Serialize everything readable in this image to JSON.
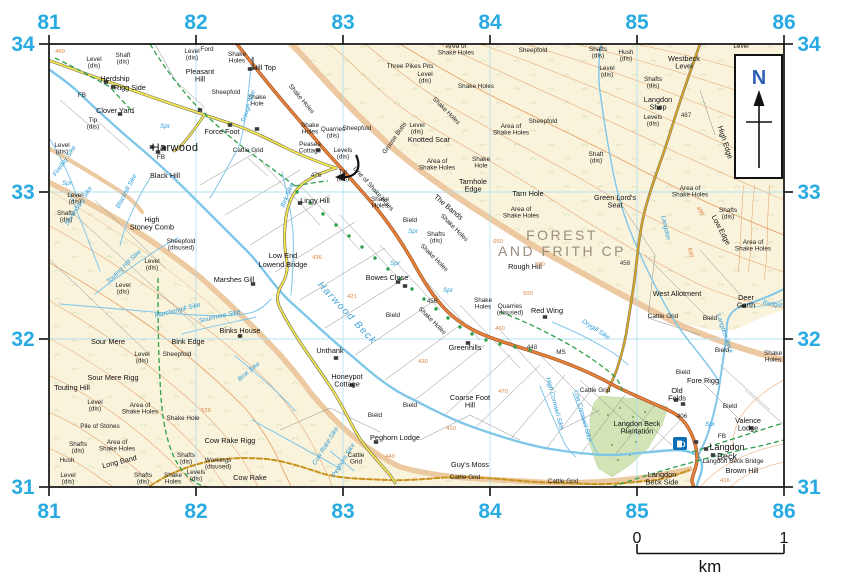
{
  "colors": {
    "grid_labels": "#29abe2",
    "b_road": "#e8803a",
    "minor_road": "#f5e74e",
    "track": "#c9921e",
    "water": "#7fc6e8",
    "footpath_green": "#2da04a",
    "contour": "#e2975c",
    "access_land": "#faf3dc",
    "woodland": "#d2e4b6",
    "cp_text": "#9a8d7d",
    "north_letter": "#2f5fb3",
    "pub_symbol": "#0d6eb5"
  },
  "map": {
    "north_label": "N",
    "scale": {
      "start": "0",
      "end": "1",
      "unit": "km"
    },
    "grid": {
      "x": {
        "labels": [
          "81",
          "82",
          "83",
          "84",
          "85",
          "86"
        ],
        "pos": [
          49,
          196,
          343,
          490,
          637,
          784
        ]
      },
      "y": {
        "labels": [
          "34",
          "33",
          "32",
          "31"
        ],
        "pos": [
          44,
          192,
          339,
          487
        ]
      }
    },
    "labels": [
      [
        94,
        61,
        "Level|(dis)",
        "s"
      ],
      [
        123,
        57,
        "Shaft|(dis)",
        "s"
      ],
      [
        115,
        81,
        "Herdship",
        "p"
      ],
      [
        130,
        90,
        "Rigg Side",
        "p"
      ],
      [
        82,
        97,
        "FB",
        "s"
      ],
      [
        115,
        113,
        "Clover Yard",
        "p"
      ],
      [
        93,
        122,
        "Tip|(dis)",
        "s"
      ],
      [
        62,
        147,
        "Level|(dis)",
        "s"
      ],
      [
        175,
        151,
        "Harwood",
        "t"
      ],
      [
        161,
        159,
        "FB",
        "s"
      ],
      [
        165,
        178,
        "Black Hill",
        "p"
      ],
      [
        192,
        53,
        "Level|(dis)",
        "s"
      ],
      [
        207,
        51,
        "Ford",
        "s"
      ],
      [
        200,
        74,
        "Pleasant|Hill",
        "p"
      ],
      [
        237,
        56,
        "Shake|Holes",
        "s"
      ],
      [
        226,
        94,
        "Sheepfold",
        "s"
      ],
      [
        257,
        99,
        "Shake|Hole",
        "s"
      ],
      [
        264,
        70,
        "Hill Top",
        "p"
      ],
      [
        222,
        134,
        "Force Foot",
        "p"
      ],
      [
        248,
        152,
        "Cattle Grid",
        "s"
      ],
      [
        67,
        185,
        "Spr",
        "w"
      ],
      [
        165,
        128,
        "Spr",
        "w"
      ],
      [
        250,
        107,
        "Trough Sike",
        "w",
        -72
      ],
      [
        66,
        162,
        "Fireday Sike",
        "w",
        -55
      ],
      [
        300,
        100,
        "Shake Holes",
        "s",
        50
      ],
      [
        310,
        127,
        "Shake|Holes",
        "s"
      ],
      [
        333,
        131,
        "Quarries|(dis)",
        "s"
      ],
      [
        357,
        130,
        "Sheepfold",
        "s"
      ],
      [
        310,
        146,
        "Peasea|Cottage",
        "s"
      ],
      [
        343,
        152,
        "Levels|(dis)",
        "s"
      ],
      [
        343,
        174,
        "Tip|(dis)",
        "s"
      ],
      [
        316,
        177,
        "476",
        "h"
      ],
      [
        372,
        190,
        "Line of Shake Holes",
        "s",
        48
      ],
      [
        456,
        48,
        "Area of|Shake Holes",
        "s"
      ],
      [
        410,
        68,
        "Three Pikes Pits",
        "s"
      ],
      [
        425,
        76,
        "Level|(dis)",
        "s"
      ],
      [
        476,
        88,
        "Shake Holes",
        "s"
      ],
      [
        533,
        52,
        "Sheepfold",
        "s"
      ],
      [
        543,
        123,
        "Sheepfold",
        "s"
      ],
      [
        511,
        128,
        "Area of|Shake Holes",
        "s"
      ],
      [
        396,
        139,
        "Grouse Butts",
        "s",
        -55
      ],
      [
        417,
        127,
        "Level|(dis)",
        "s"
      ],
      [
        429,
        142,
        "Knotted Scar",
        "p"
      ],
      [
        437,
        163,
        "Area of|Shake Holes",
        "s"
      ],
      [
        481,
        161,
        "Shake|Hole",
        "s"
      ],
      [
        445,
        112,
        "Shake Holes",
        "s",
        45
      ],
      [
        473,
        184,
        "Tarnhole|Edge",
        "p"
      ],
      [
        598,
        51,
        "Shafts|(dis)",
        "s"
      ],
      [
        626,
        54,
        "Hush|(dis)",
        "s"
      ],
      [
        607,
        70,
        "Level|(dis)",
        "s"
      ],
      [
        684,
        61,
        "Westbeck|Level",
        "p"
      ],
      [
        653,
        81,
        "Shafts|(dis)",
        "s"
      ],
      [
        658,
        102,
        "Langdon|Shop",
        "p"
      ],
      [
        653,
        119,
        "Levels|(dis)",
        "s"
      ],
      [
        686,
        117,
        "487",
        "h"
      ],
      [
        723,
        143,
        "High Edge",
        "p",
        72
      ],
      [
        596,
        156,
        "Shaft|(dis)",
        "s"
      ],
      [
        741,
        48,
        "Level",
        "s"
      ],
      [
        690,
        190,
        "Area of|Shake Holes",
        "s"
      ],
      [
        728,
        212,
        "Shafts|(dis)",
        "s"
      ],
      [
        719,
        231,
        "Low Edge",
        "p",
        62
      ],
      [
        753,
        244,
        "Area of|Shake Holes",
        "s"
      ],
      [
        315,
        203,
        "Lingy Hill",
        "p"
      ],
      [
        289,
        196,
        "Birk Sike",
        "w",
        -68
      ],
      [
        380,
        201,
        "Shake|Holes",
        "s"
      ],
      [
        447,
        209,
        "The Bands",
        "p",
        40
      ],
      [
        453,
        229,
        "Shake Holes",
        "s",
        45
      ],
      [
        410,
        222,
        "Bield",
        "s"
      ],
      [
        413,
        233,
        "Spr",
        "w"
      ],
      [
        436,
        236,
        "Shafts|(dis)",
        "s"
      ],
      [
        433,
        259,
        "Shake Holes",
        "s",
        45
      ],
      [
        283,
        258,
        "Low End",
        "p"
      ],
      [
        283,
        267,
        "Lowend Bridge",
        "p"
      ],
      [
        317,
        259,
        "436",
        "o"
      ],
      [
        387,
        280,
        "Bowes Close",
        "p"
      ],
      [
        395,
        265,
        "Spr",
        "w"
      ],
      [
        352,
        298,
        "421",
        "o"
      ],
      [
        345,
        315,
        "Harwood Beck",
        "wb",
        47
      ],
      [
        393,
        317,
        "Bield",
        "s"
      ],
      [
        432,
        303,
        "458",
        "h"
      ],
      [
        431,
        322,
        "Shake Holes",
        "s",
        45
      ],
      [
        448,
        292,
        "Spr",
        "w"
      ],
      [
        483,
        302,
        "Shake|Holes",
        "s"
      ],
      [
        510,
        308,
        "Quarries|(disused)",
        "s"
      ],
      [
        547,
        313,
        "Red Wing",
        "p"
      ],
      [
        465,
        350,
        "Greenhills",
        "p"
      ],
      [
        532,
        349,
        "448",
        "h"
      ],
      [
        561,
        354,
        "MS",
        "s"
      ],
      [
        330,
        353,
        "Unthank",
        "p"
      ],
      [
        152,
        222,
        "High|Stoney Comb",
        "p"
      ],
      [
        181,
        243,
        "Sheepfold|(disused)",
        "s"
      ],
      [
        152,
        263,
        "Level|(dis)",
        "s"
      ],
      [
        123,
        287,
        "Level|(dis)",
        "s"
      ],
      [
        75,
        197,
        "Level|(dis)",
        "s"
      ],
      [
        66,
        215,
        "Shafts|(dis)",
        "s"
      ],
      [
        128,
        192,
        "Blackhill Sike",
        "w",
        -62
      ],
      [
        80,
        207,
        "Sevendarg Sike",
        "w",
        -57
      ],
      [
        125,
        268,
        "Touting Hill Sike",
        "w",
        -44
      ],
      [
        234,
        282,
        "Marshes Gill",
        "p"
      ],
      [
        178,
        312,
        "Marchengill Sike",
        "w",
        -14
      ],
      [
        220,
        318,
        "Sourmere Sike",
        "w",
        -13
      ],
      [
        240,
        333,
        "Binks House",
        "p"
      ],
      [
        188,
        344,
        "Bink Edge",
        "p"
      ],
      [
        177,
        356,
        "Sheepfold",
        "s"
      ],
      [
        108,
        344,
        "Sour Mere",
        "p"
      ],
      [
        142,
        356,
        "Level|(dis)",
        "s"
      ],
      [
        28,
        331,
        "Area of|Shake Holes",
        "s"
      ],
      [
        113,
        380,
        "Sour Mere Rigg",
        "p"
      ],
      [
        72,
        390,
        "Touting Hill",
        "p"
      ],
      [
        95,
        404,
        "Level|(dis)",
        "s"
      ],
      [
        22,
        415,
        "Shake Holes",
        "s"
      ],
      [
        140,
        407,
        "Area of|Shake Holes",
        "s"
      ],
      [
        100,
        428,
        "Pile of Stones",
        "s"
      ],
      [
        78,
        446,
        "Shafts|(dis)",
        "s"
      ],
      [
        117,
        444,
        "Area of|Shake Holes",
        "s"
      ],
      [
        67,
        462,
        "Hush",
        "s"
      ],
      [
        120,
        464,
        "Long Band",
        "p",
        -14
      ],
      [
        68,
        477,
        "Level|(dis)",
        "s"
      ],
      [
        143,
        477,
        "Shafts|(dis)",
        "s"
      ],
      [
        173,
        477,
        "Shake|Holes",
        "s"
      ],
      [
        196,
        474,
        "Levels|(dis)",
        "s"
      ],
      [
        183,
        420,
        "Shake Hole",
        "s"
      ],
      [
        206,
        412,
        "529",
        "o"
      ],
      [
        230,
        443,
        "Cow Rake Rigg",
        "p"
      ],
      [
        186,
        457,
        "Shafts|(dis)",
        "s"
      ],
      [
        218,
        462,
        "Workings|(disused)",
        "s"
      ],
      [
        250,
        480,
        "Cow Rake",
        "p"
      ],
      [
        250,
        373,
        "Bink Sike",
        "w",
        -40
      ],
      [
        327,
        447,
        "Cow Rake Sike",
        "w",
        -58
      ],
      [
        345,
        461,
        "Peghorn Sike",
        "w",
        -58
      ],
      [
        356,
        457,
        "Cattle|Grid",
        "s"
      ],
      [
        347,
        379,
        "Honeypot|Cottage",
        "p"
      ],
      [
        375,
        417,
        "Bield",
        "s"
      ],
      [
        410,
        407,
        "Bield",
        "s"
      ],
      [
        395,
        440,
        "Peghorn Lodge",
        "p"
      ],
      [
        470,
        400,
        "Coarse Foot|Hill",
        "p"
      ],
      [
        470,
        467,
        "Guy's Moss",
        "p"
      ],
      [
        465,
        479,
        "Cattle Grid",
        "s"
      ],
      [
        563,
        483,
        "Cattle Grid",
        "s"
      ],
      [
        562,
        240,
        "FOREST",
        "g"
      ],
      [
        562,
        256,
        "AND FRITH CP",
        "g"
      ],
      [
        525,
        269,
        "Rough Hill",
        "p"
      ],
      [
        528,
        196,
        "Tarn Hole",
        "p"
      ],
      [
        521,
        211,
        "Area of|Shake Holes",
        "s"
      ],
      [
        615,
        200,
        "Green Lord's|Seat",
        "p"
      ],
      [
        664,
        228,
        "Langdon",
        "w",
        78
      ],
      [
        625,
        265,
        "458",
        "h"
      ],
      [
        677,
        296,
        "West Allotment",
        "p"
      ],
      [
        663,
        318,
        "Cattle Grid",
        "s"
      ],
      [
        710,
        320,
        "Bield",
        "s"
      ],
      [
        746,
        300,
        "Deer|Garth",
        "p"
      ],
      [
        779,
        307,
        "Redgill Sike",
        "w",
        10
      ],
      [
        723,
        334,
        "Langdon Beck",
        "w",
        72
      ],
      [
        773,
        355,
        "Shake|Holes",
        "s"
      ],
      [
        722,
        352,
        "Bield",
        "s"
      ],
      [
        595,
        331,
        "Drygill Sike",
        "w",
        33
      ],
      [
        553,
        404,
        "High Cornwell Sike",
        "w",
        75
      ],
      [
        581,
        416,
        "Low Cornwell Sike",
        "w",
        75
      ],
      [
        595,
        392,
        "Cattle Grid",
        "s"
      ],
      [
        683,
        374,
        "Bield",
        "s"
      ],
      [
        703,
        383,
        "Fore Rigg",
        "p"
      ],
      [
        677,
        393,
        "Old|Folds",
        "p"
      ],
      [
        730,
        408,
        "Bield",
        "s"
      ],
      [
        637,
        426,
        "Langdon Beck|Plantation",
        "p"
      ],
      [
        682,
        418,
        "406",
        "h"
      ],
      [
        748,
        423,
        "Valence|Lodge",
        "p"
      ],
      [
        710,
        426,
        "Spr",
        "w"
      ],
      [
        722,
        438,
        "FB",
        "s"
      ],
      [
        727,
        450,
        "Langdon|Beck",
        "t2"
      ],
      [
        733,
        463,
        "Langdon Beck Bridge",
        "s"
      ],
      [
        742,
        473,
        "Brown Hill",
        "p"
      ],
      [
        662,
        477,
        "Langdon|Beck Side",
        "p"
      ],
      [
        725,
        482,
        "416",
        "o"
      ],
      [
        60,
        53,
        "460",
        "o"
      ],
      [
        498,
        243,
        "650",
        "o"
      ],
      [
        540,
        266,
        "530",
        "o"
      ],
      [
        528,
        295,
        "500",
        "o"
      ],
      [
        500,
        330,
        "460",
        "o"
      ],
      [
        423,
        363,
        "430",
        "o"
      ],
      [
        503,
        393,
        "470",
        "o"
      ],
      [
        451,
        430,
        "410",
        "o"
      ],
      [
        390,
        458,
        "440",
        "o"
      ],
      [
        689,
        253,
        "630",
        "o",
        75
      ],
      [
        699,
        212,
        "490",
        "o",
        55
      ]
    ],
    "buildings": [
      [
        106,
        82
      ],
      [
        113,
        87
      ],
      [
        152,
        147
      ],
      [
        158,
        152
      ],
      [
        164,
        148
      ],
      [
        250,
        69
      ],
      [
        230,
        125
      ],
      [
        318,
        150
      ],
      [
        300,
        203
      ],
      [
        398,
        282
      ],
      [
        405,
        286
      ],
      [
        468,
        343
      ],
      [
        545,
        317
      ],
      [
        336,
        358
      ],
      [
        352,
        385
      ],
      [
        376,
        442
      ],
      [
        240,
        336
      ],
      [
        253,
        284
      ],
      [
        676,
        400
      ],
      [
        683,
        404
      ],
      [
        696,
        442
      ],
      [
        706,
        449
      ],
      [
        713,
        455
      ],
      [
        751,
        428
      ],
      [
        744,
        306
      ],
      [
        120,
        114
      ],
      [
        200,
        110
      ],
      [
        257,
        129
      ],
      [
        659,
        108
      ]
    ],
    "tree_dots": [
      [
        297,
        192
      ],
      [
        310,
        203
      ],
      [
        323,
        214
      ],
      [
        336,
        225
      ],
      [
        349,
        236
      ],
      [
        362,
        247
      ],
      [
        375,
        258
      ],
      [
        388,
        269
      ],
      [
        400,
        279
      ],
      [
        412,
        289
      ],
      [
        424,
        299
      ],
      [
        436,
        309
      ],
      [
        448,
        318
      ],
      [
        460,
        327
      ],
      [
        472,
        334
      ],
      [
        486,
        340
      ],
      [
        500,
        344
      ],
      [
        515,
        347
      ],
      [
        530,
        350
      ]
    ]
  }
}
